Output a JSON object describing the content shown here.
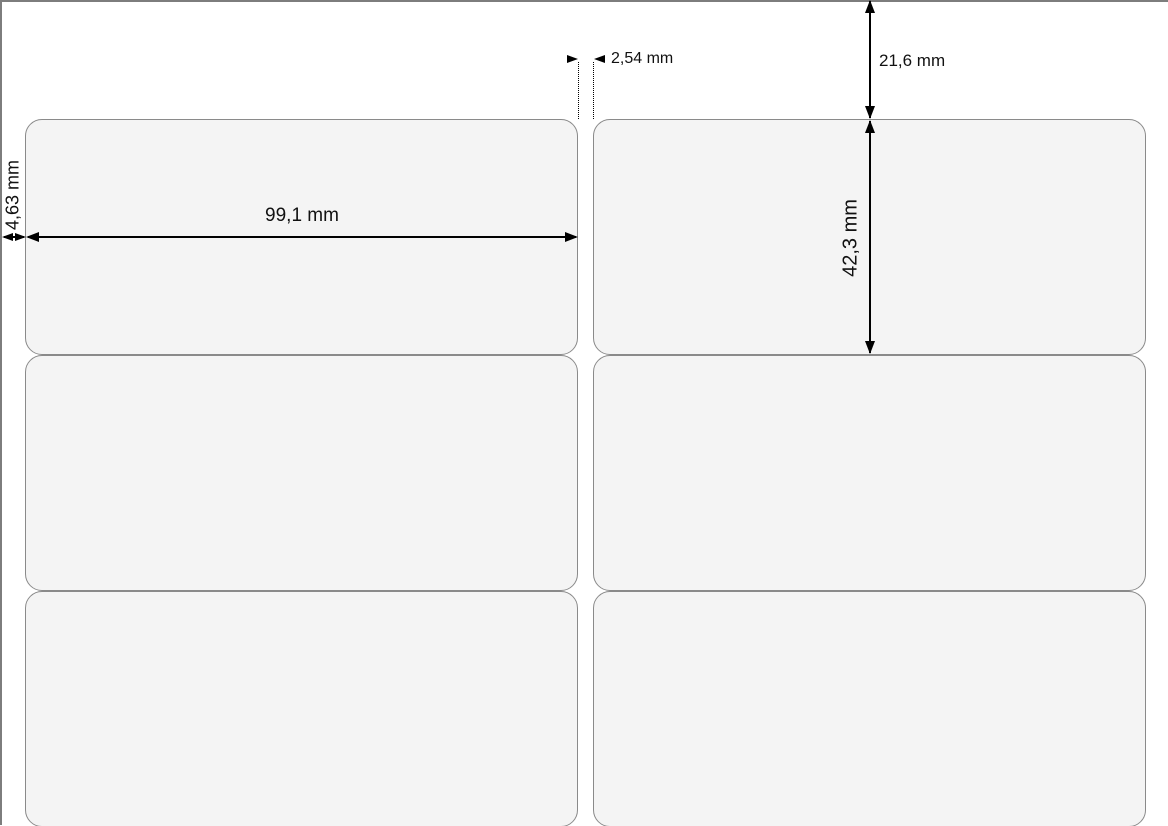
{
  "diagram": {
    "type": "label-sheet-template-drawing",
    "sheet": {
      "columns": 2,
      "rows_visible": 3
    },
    "dims": {
      "label_width": "99,1 mm",
      "label_height": "42,3 mm",
      "left_margin": "4,63 mm",
      "top_margin": "21,6 mm",
      "horizontal_gap": "2,54 mm"
    },
    "colors": {
      "background": "#ffffff",
      "label_fill": "#f4f4f4",
      "label_border": "#8a8a8a",
      "sheet_edge": "#7d7d7d",
      "dimension_ink": "#000000"
    }
  }
}
